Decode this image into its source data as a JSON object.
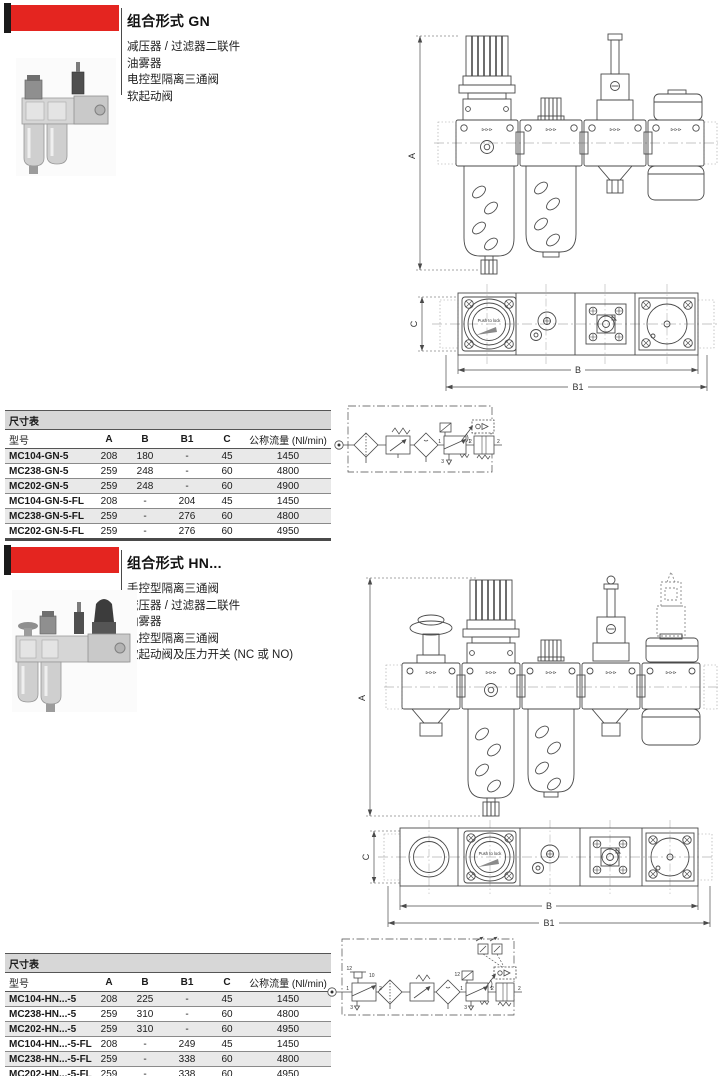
{
  "page": {
    "bg": "#ffffff",
    "accent_red": "#e42520",
    "bar_black": "#1a1a1a",
    "drawing_line": "#4a4a4a"
  },
  "sections": [
    {
      "title": "组合形式 GN",
      "description": [
        "减压器 / 过滤器二联件",
        "油雾器",
        "电控型隔离三通阀",
        "软起动阀"
      ],
      "table": {
        "caption": "尺寸表",
        "headers": [
          "型号",
          "A",
          "B",
          "B1",
          "C",
          "公称流量  (Nl/min)"
        ],
        "rows": [
          [
            "MC104-GN-5",
            "208",
            "180",
            "-",
            "45",
            "1450"
          ],
          [
            "MC238-GN-5",
            "259",
            "248",
            "-",
            "60",
            "4800"
          ],
          [
            "MC202-GN-5",
            "259",
            "248",
            "-",
            "60",
            "4900"
          ],
          [
            "MC104-GN-5-FL",
            "208",
            "-",
            "204",
            "45",
            "1450"
          ],
          [
            "MC238-GN-5-FL",
            "259",
            "-",
            "276",
            "60",
            "4800"
          ],
          [
            "MC202-GN-5-FL",
            "259",
            "-",
            "276",
            "60",
            "4950"
          ]
        ]
      },
      "drawing": {
        "dim_a": "A",
        "dim_b": "B",
        "dim_b1": "B1",
        "dim_c": "C",
        "gauge_text": "Push to lock",
        "flow_mark": "⊳⊳⊳"
      },
      "circuit": {
        "label_1": "1",
        "label_2": "2",
        "label_3": "3"
      }
    },
    {
      "title": "组合形式 HN...",
      "description": [
        "手控型隔离三通阀",
        "减压器 / 过滤器二联件",
        "油雾器",
        "电控型隔离三通阀",
        "软起动阀及压力开关  (NC 或 NO)"
      ],
      "table": {
        "caption": "尺寸表",
        "headers": [
          "型号",
          "A",
          "B",
          "B1",
          "C",
          "公称流量  (Nl/min)"
        ],
        "rows": [
          [
            "MC104-HN...-5",
            "208",
            "225",
            "-",
            "45",
            "1450"
          ],
          [
            "MC238-HN...-5",
            "259",
            "310",
            "-",
            "60",
            "4800"
          ],
          [
            "MC202-HN...-5",
            "259",
            "310",
            "-",
            "60",
            "4950"
          ],
          [
            "MC104-HN...-5-FL",
            "208",
            "-",
            "249",
            "45",
            "1450"
          ],
          [
            "MC238-HN...-5-FL",
            "259",
            "-",
            "338",
            "60",
            "4800"
          ],
          [
            "MC202-HN...-5-FL",
            "259",
            "-",
            "338",
            "60",
            "4950"
          ]
        ]
      },
      "drawing": {
        "dim_a": "A",
        "dim_b": "B",
        "dim_b1": "B1",
        "dim_c": "C",
        "gauge_text": "Push to lock",
        "flow_mark": "⊳⊳⊳"
      },
      "circuit": {
        "label_1": "1",
        "label_2": "2",
        "label_3": "3",
        "label_10": "10",
        "label_12": "12"
      }
    }
  ]
}
